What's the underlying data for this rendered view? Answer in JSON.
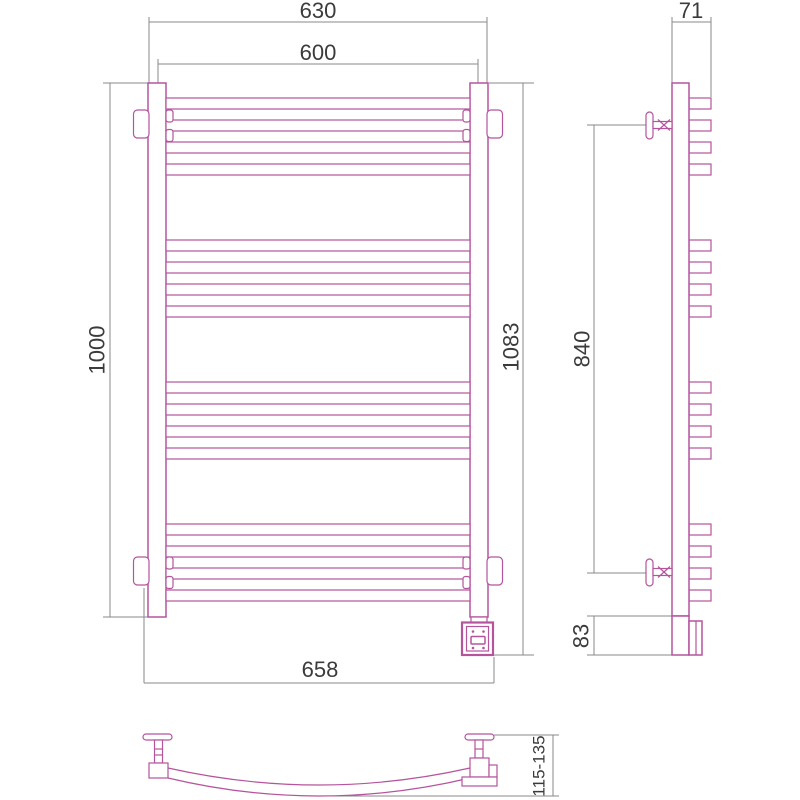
{
  "colors": {
    "product": "#b5549d",
    "dim-line": "#8a8a8a",
    "dim-text": "#3b3b3b"
  },
  "front_view": {
    "dim_outer_width": "630",
    "dim_center_width": "600",
    "dim_rail_height": "1000",
    "dim_total_height": "1083",
    "dim_total_width": "658"
  },
  "side_view": {
    "dim_depth": "71",
    "dim_bracket_span": "840",
    "dim_box_height": "83"
  },
  "bottom_view": {
    "dim_wall_distance": "115-135"
  }
}
